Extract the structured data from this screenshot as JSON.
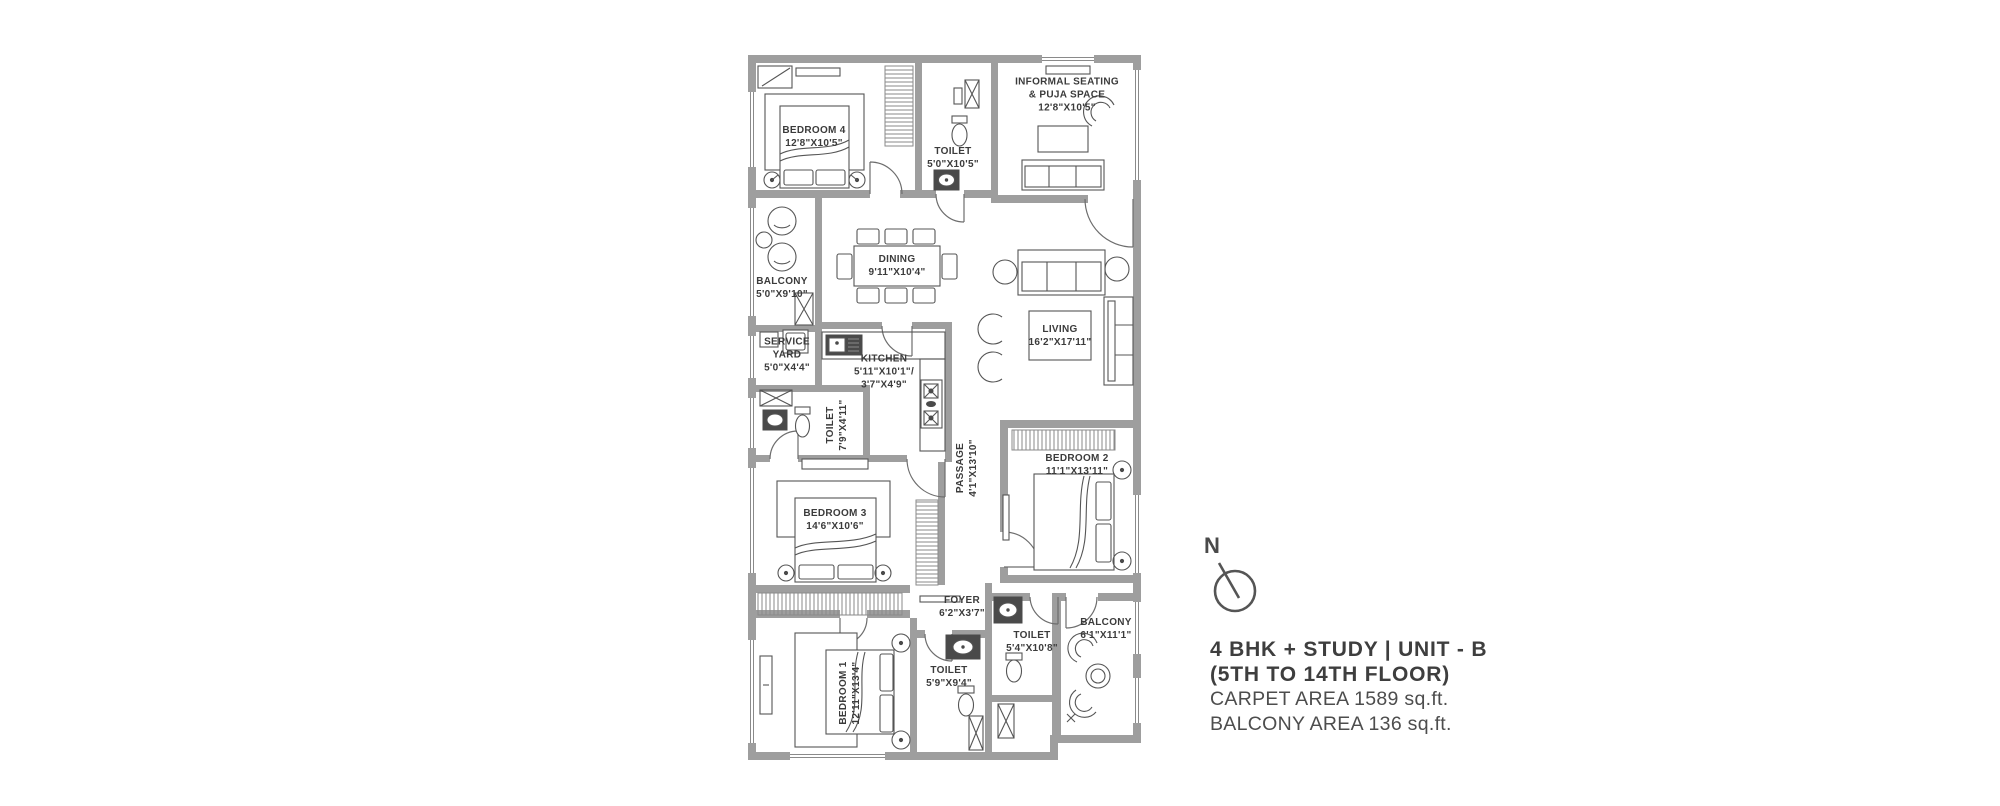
{
  "colors": {
    "wall": "#9e9e9e",
    "furniture_line": "#555555",
    "label_text": "#3b3b3b",
    "legend_text": "#3e3e3e"
  },
  "plan": {
    "rooms": [
      {
        "name": "bedroom-4",
        "lines": [
          "BEDROOM 4",
          "12'8\"X10'5\""
        ]
      },
      {
        "name": "toilet-top",
        "lines": [
          "TOILET",
          "5'0\"X10'5\""
        ]
      },
      {
        "name": "informal-seating",
        "lines": [
          "INFORMAL SEATING",
          "& PUJA SPACE",
          "12'8\"X10'5\""
        ]
      },
      {
        "name": "balcony-left",
        "lines": [
          "BALCONY",
          "5'0\"X9'10\""
        ]
      },
      {
        "name": "dining",
        "lines": [
          "DINING",
          "9'11\"X10'4\""
        ]
      },
      {
        "name": "living",
        "lines": [
          "LIVING",
          "16'2\"X17'11\""
        ]
      },
      {
        "name": "service-yard",
        "lines": [
          "SERVICE",
          "YARD",
          "5'0\"X4'4\""
        ]
      },
      {
        "name": "kitchen",
        "lines": [
          "KITCHEN",
          "5'11\"X10'1\"/",
          "3'7\"X4'9\""
        ]
      },
      {
        "name": "toilet-common",
        "lines": [
          "TOILET",
          "7'9\"X4'11\""
        ]
      },
      {
        "name": "passage",
        "lines": [
          "PASSAGE",
          "4'1\"X13'10\""
        ]
      },
      {
        "name": "bedroom-2",
        "lines": [
          "BEDROOM 2",
          "11'1\"X13'11\""
        ]
      },
      {
        "name": "bedroom-3",
        "lines": [
          "BEDROOM 3",
          "14'6\"X10'6\""
        ]
      },
      {
        "name": "foyer",
        "lines": [
          "FOYER",
          "6'2\"X3'7\""
        ]
      },
      {
        "name": "toilet-2",
        "lines": [
          "TOILET",
          "5'4\"X10'8\""
        ]
      },
      {
        "name": "balcony-2",
        "lines": [
          "BALCONY",
          "6'1\"X11'1\""
        ]
      },
      {
        "name": "bedroom-1",
        "lines": [
          "BEDROOM 1",
          "12'11\"X13'4\""
        ]
      },
      {
        "name": "toilet-1",
        "lines": [
          "TOILET",
          "5'9\"X9'4\""
        ]
      }
    ]
  },
  "legend": {
    "north": "N",
    "title_line1": "4 BHK + STUDY | UNIT - B",
    "title_line2": "(5TH TO 14TH FLOOR)",
    "carpet_area": "CARPET AREA 1589 sq.ft.",
    "balcony_area": "BALCONY AREA 136 sq.ft."
  }
}
